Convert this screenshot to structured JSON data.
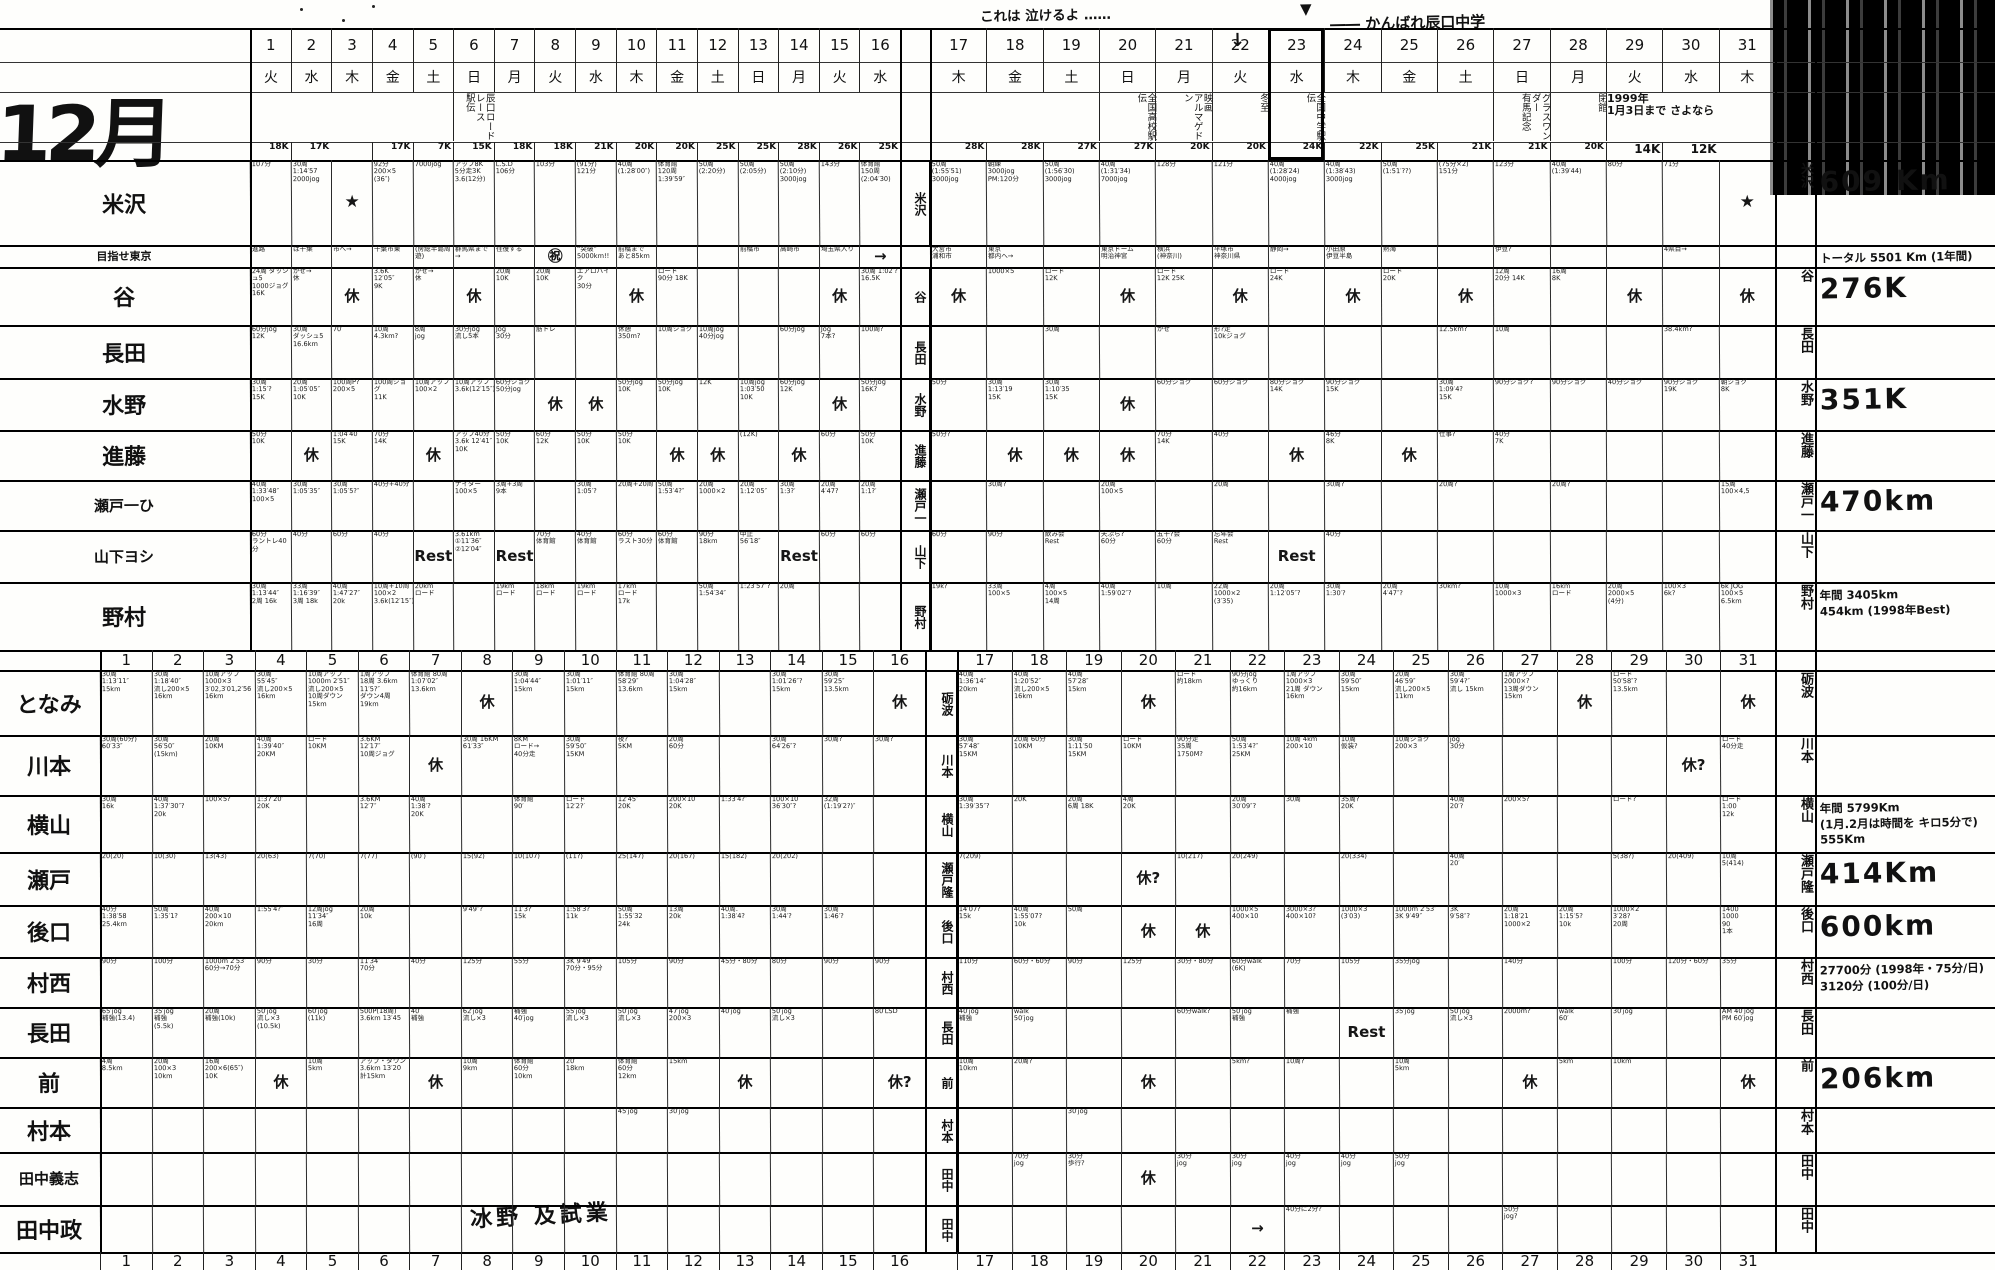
{
  "title": "12月",
  "annotations": {
    "cry_note": "これは 泣けるよ ‥‥‥",
    "cry_arrow": "↓",
    "cheer_note": "―― かんばれ辰口中学",
    "cheer_arrow": "▼",
    "footer_note": "冰野 及試業"
  },
  "days_left": [
    "1",
    "2",
    "3",
    "4",
    "5",
    "6",
    "7",
    "8",
    "9",
    "10",
    "11",
    "12",
    "13",
    "14",
    "15",
    "16"
  ],
  "days_right": [
    "17",
    "18",
    "19",
    "20",
    "21",
    "22",
    "23",
    "24",
    "25",
    "26",
    "27",
    "28",
    "29",
    "30",
    "31"
  ],
  "weekdays_left": [
    "火",
    "水",
    "木",
    "金",
    "土",
    "日",
    "月",
    "火",
    "水",
    "木",
    "金",
    "土",
    "日",
    "月",
    "火",
    "水"
  ],
  "weekdays_right": [
    "木",
    "金",
    "土",
    "日",
    "月",
    "火",
    "水",
    "木",
    "金",
    "土",
    "日",
    "月",
    "火",
    "水",
    "木"
  ],
  "events": {
    "6": "辰口ロードレース\n駅伝",
    "20": "全国高校駅伝",
    "21": "映画\nアルマゲドン",
    "22": "冬至",
    "23": "全国中学駅伝",
    "27": "グラスワンダー\n有馬記念",
    "28": "閉館",
    "29": "1999年\n1月3日まで さよなら"
  },
  "plan_k": [
    "18K",
    "17K",
    "",
    "17K",
    "7K",
    "15K",
    "18K",
    "18K",
    "21K",
    "20K",
    "20K",
    "25K",
    "25K",
    "28K",
    "26K",
    "25K",
    "28K",
    "28K",
    "27K",
    "27K",
    "20K",
    "20K",
    "24K",
    "22K",
    "25K",
    "21K",
    "21K",
    "20K",
    "14K",
    "12K",
    ""
  ],
  "upper_rows": [
    {
      "id": "yonezawa",
      "name": "米沢",
      "mid": "米沢",
      "total": "609 Km",
      "cells": [
        "107分",
        "30周\n1:14′57\n2000jog",
        "★",
        "92分\n200×5\n(36″)",
        "7000jog",
        "アップ8K\n5分走3K\n3.6(12分)",
        "L.S.D\n106分",
        "103分",
        "(91分)\n121分",
        "40周\n(1:28′00″)",
        "体育館\n120周\n1:39′59″",
        "50周\n(2:20分)",
        "50周\n(2:05分)",
        "50周\n(2:10分)\n3000jog",
        "143分",
        "体育館\n150周\n(2:04′30)",
        "50周\n(1:55′51)\n3000jog",
        "朝練\n3000jog\nPM:120分",
        "50周\n(1:56′30)\n3000jog",
        "40周\n(1:31′34)\n7000jog",
        "128分",
        "121分",
        "40周\n(1:28′24)\n4000jog",
        "40周\n(1:38′43)\n3000jog",
        "50周\n(1:51′??)",
        "(75分×2)\n151分",
        "123分",
        "40周\n(1:39′44)",
        "80分",
        "71分",
        "★"
      ]
    },
    {
      "id": "progress",
      "name": "目指せ東京",
      "mid": "",
      "total": "トータル 5501 Km (1年間)",
      "cells": [
        "進路",
        "は千葉",
        "市へ→",
        "千葉市東",
        "(房総半島周遊)",
        "群馬県まで→",
        "往復する",
        "㊗",
        "“突破”\n5000km!!",
        "前橋まで\nあと85km",
        "",
        "",
        "前橋市",
        "高崎市",
        "埼玉県入り",
        "→",
        "大宮市\n浦和市",
        "東京\n都内へ→",
        "",
        "東京ドーム\n明治神宮",
        "横浜\n(神奈川)",
        "平塚市\n神奈川県",
        "静岡→",
        "小田原\n伊豆半島",
        "熱海",
        "",
        "伊豆?",
        "",
        "",
        "4県目→",
        ""
      ]
    },
    {
      "id": "tani",
      "name": "谷",
      "mid": "谷",
      "total": "276K",
      "cells": [
        "24周 ダッシュ5\n1000ジョグ\n16K",
        "かぜ→\n休",
        "休",
        "3.6K\n12′05″\n9K",
        "かぜ→\n休",
        "休",
        "20周\n10K",
        "20周\n10K",
        "エアロバイク\n30分",
        "休",
        "ロード\n90分 18K",
        "",
        "",
        "",
        "休",
        "30周 1:02′?\n16.5K",
        "休",
        "1000×5",
        "ロード\n12K",
        "休",
        "ロード\n12K 25K",
        "休",
        "ロード\n24K",
        "休",
        "ロード\n20K",
        "休",
        "12周\n20分 14K",
        "16周\n8K",
        "休",
        "",
        "休"
      ]
    },
    {
      "id": "nagata-u",
      "name": "長田",
      "mid": "長田",
      "total": "",
      "cells": [
        "60分jog\n12K",
        "30周\nダッシュ5\n16.6km",
        "70′",
        "10周\n4.3km?",
        "8周\njog",
        "30分jog\n流し5本",
        "Jog\n30分",
        "筋トレ",
        "",
        "休憩\n350m?",
        "10周ジョグ",
        "10周jog\n40分jog",
        "",
        "60分jog",
        "Jog\n7本?",
        "100周?",
        "",
        "",
        "30周",
        "",
        "かぜ",
        "形?走\n10kジョグ",
        "",
        "",
        "",
        "12.5km?",
        "10周",
        "",
        "",
        "38.4km?",
        ""
      ]
    },
    {
      "id": "mizuno",
      "name": "水野",
      "mid": "水野",
      "total": "351K",
      "cells": [
        "30周\n1:15′?\n15K",
        "20周\n1:05′05″\n10K",
        "100周P?\n200×5",
        "100周ジョグ\n11K",
        "10周アップ\n100×2",
        "10周アップ\n3.6k(12′15″)",
        "60分ジョグ\n50分jog",
        "休",
        "休",
        "50分jog\n10K",
        "50分jog\n10K",
        "12K",
        "10周jog\n1:03′50\n10K",
        "60分jog\n12K",
        "休",
        "50分jog\n16K?",
        "50分",
        "30周\n1:13′19\n15K",
        "30周\n1:10′35\n15K",
        "休",
        "60分ジョグ",
        "60分ジョグ",
        "80分ジョグ\n14K",
        "90分ジョグ\n15K",
        "",
        "30周\n1:09′4?\n15K",
        "90分ジョグ?",
        "90分ジョグ",
        "40分ジョグ",
        "90分ジョグ\n19K",
        "朝ジョグ\n8K"
      ]
    },
    {
      "id": "shindo",
      "name": "進藤",
      "mid": "進藤",
      "total": "",
      "cells": [
        "50分\n10K",
        "休",
        "1:04′40\n15K",
        "70分\n14K",
        "休",
        "アップ40分\n3.6k 12′41″\n10K",
        "50分\n10K",
        "60分\n12K",
        "50分\n10K",
        "50分\n10K",
        "休",
        "休",
        "(12K)",
        "休",
        "60分",
        "50分\n10K",
        "50分?",
        "休",
        "休",
        "休",
        "70分\n14K",
        "40分",
        "休",
        "46分\n8K",
        "休",
        "仕事?",
        "40分\n7K",
        "",
        "",
        "",
        ""
      ]
    },
    {
      "id": "seto-h",
      "name": "瀬戸一ひ",
      "mid": "瀬戸一",
      "total": "470km",
      "cells": [
        "40周\n1:33′48″\n100×5",
        "30周\n1:05′35″",
        "30周\n1:05′5?″",
        "40分+40分",
        "",
        "ナイター\n100×5",
        "3周+3周\n9本",
        "",
        "30周\n1:05′?",
        "20周+20周",
        "50周\n1:53′4?″",
        "20周\n1000×2",
        "20周\n1:12′05″",
        "30周\n1:3?′",
        "20周\n4′47?",
        "20周\n1:1?′",
        "",
        "30周?",
        "",
        "20周\n100×5",
        "",
        "20周",
        "",
        "30周?",
        "",
        "20周?",
        "",
        "20周?",
        "",
        "",
        "15周\n100×4,5"
      ]
    },
    {
      "id": "yamashita",
      "name": "山下ヨシ",
      "mid": "山下",
      "total": "",
      "cells": [
        "60分\nラントレ40分",
        "40分",
        "60分",
        "40分",
        "Rest",
        "3.61km\n①11′36″\n②12′04″",
        "Rest",
        "70分\n体育館",
        "40分\n体育館",
        "60分\nラスト30分",
        "60分\n体育館",
        "90分\n18km",
        "中止\n56′18″",
        "Rest",
        "60分",
        "60分",
        "60分",
        "90分",
        "飲み会\nRest",
        "天ぷら?\n60分",
        "五十?会\n60分",
        "忘年会\nRest",
        "Rest",
        "40分",
        "",
        "",
        "",
        "",
        "",
        "",
        ""
      ]
    },
    {
      "id": "nomura",
      "name": "野村",
      "mid": "野村",
      "total": "年間 3405km\n454km (1998年Best)",
      "cells": [
        "30周\n1:13′44″\n2周 16k",
        "33周\n1:16′39″\n3周 18k",
        "40周\n1:47′27″\n20k",
        "10周+10周\n100×2\n3.6k(12′15″)",
        "20km\nロード",
        "",
        "19km\nロード",
        "18km\nロード",
        "19km\nロード",
        "17km\nロード\n17k",
        "",
        "50周\n1:54′34″",
        "1:23′57″?",
        "20周",
        "",
        "",
        "19k?",
        "33周\n100×5",
        "4周\n100×5\n14周",
        "40周\n1:59′02″?",
        "10周",
        "22周\n1000×2\n(3′35)",
        "20周\n1:12′05″?",
        "30周\n1:30′?",
        "20周\n4′47″?",
        "30km?",
        "10周\n1000×3",
        "16km\nロード",
        "20周\n2000×5\n(4分)",
        "100×3\n6k?",
        "6k JOG\n100×5\n6.5km"
      ]
    }
  ],
  "lower_rows": [
    {
      "id": "tonami",
      "name": "となみ",
      "mid": "砺波",
      "total": "",
      "cells": [
        "30周\n1:13′11″\n15km",
        "30周\n1:18′40″\n流し200×5\n16km",
        "10周アップ\n1000×3\n3′02,3′01,2′56\n16km",
        "30周\n55′45″\n流し200×5\n16km",
        "10周アップ\n1000m 2′51″\n流し200×5\n10周ダウン 15km",
        "1周アップ\n18周 3.6km 11′5?″\nダウン4周 19km",
        "体育館 80周\n1:07′02″\n13.6km",
        "休",
        "30周\n1:04′44″\n15km",
        "30周\n1:01′11″\n15km",
        "体育館 80周\n58′29″\n13.6km",
        "30周\n1:04′28″\n15km",
        "",
        "30周\n1:01′26″?\n15km",
        "30周\n59′25″\n13.5km",
        "休",
        "40周\n1:36′14″\n20km",
        "40周\n1:20′52″\n流し200×5 16km",
        "40周\n57′28″\n15km",
        "休",
        "ロード\n約18km",
        "90分jog\nゆっくり\n約16km",
        "1周アップ\n1000×3\n21周 ダウン 16km",
        "30周\n59′50″\n15km",
        "20周\n46′59″\n流し200×5 11km",
        "30周\n59′4?″\n流し 15km",
        "1周アップ\n2000×?\n13周ダウン 15km",
        "休",
        "ロード\n50′58″?\n13.5km",
        "",
        "休"
      ]
    },
    {
      "id": "kawamoto",
      "name": "川本",
      "mid": "川本",
      "total": "",
      "cells": [
        "30周(60分)\n60′33″",
        "30周\n56′50″\n(15km)",
        "20周\n10KM",
        "40周\n1:39′40″\n20KM",
        "ロード\n10KM",
        "3.6KM\n12′17″\n10周ジョグ",
        "休",
        "30周 16KM\n61′33″",
        "8KM\nロード→\n40分走",
        "30周\n59′50″\n15KM",
        "夜?\n5KM",
        "20周\n60分",
        "",
        "30周\n64′26″?",
        "30周?",
        "30周?",
        "30周\n57′48″\n15KM",
        "20周 60分\n10KM",
        "30周\n1:11′50\n15KM",
        "ロード\n10KM",
        "90分走\n35周\n1750M?",
        "50周\n1:53′4?″\n25KM",
        "10周 4km\n200×10",
        "10周\n仮装?",
        "10周ジョグ\n200×3",
        "jog\n30分",
        "",
        "",
        "",
        "休?",
        "ロード\n40分走"
      ]
    },
    {
      "id": "yokoyama",
      "name": "横山",
      "mid": "横山",
      "total": "年間 5799Km\n(1月.2月は時間を キロ5分で)\n555Km",
      "cells": [
        "30周\n16k",
        "40周\n1:37′30″?\n20k",
        "100×5?",
        "1:37′20″\n20K",
        "",
        "3.6KM\n12′7″",
        "40周\n1:38′?\n20K",
        "",
        "体育館\n90′",
        "ロード\n12′2?′",
        "12′45″\n20K",
        "200×10\n20K",
        "1:33′4?″",
        "100×10\n36′30″?",
        "32周\n(1:19′2?)″",
        "",
        "30周\n1:39′35″?",
        "20K",
        "20周\n6周 18K",
        "4周\n20K",
        "",
        "20周\n30′09″?",
        "30周",
        "35周?\n20K",
        "",
        "40周\n20′?",
        "200×5?",
        "",
        "ロード?",
        "",
        "ロード\n1:00\n12k"
      ]
    },
    {
      "id": "seto-t",
      "name": "瀬戸",
      "mid": "瀬戸隆",
      "total": "414Km",
      "cells": [
        "20(20)",
        "10(30)",
        "13(43)",
        "20(63)",
        "7(70)",
        "7(77)",
        "(90′)",
        "15(92)",
        "10(107)",
        "(11?)",
        "25(147)",
        "20(167)",
        "15(182)",
        "20(202)",
        "",
        "",
        "7(209)",
        "",
        "",
        "休?",
        "10(217)",
        "20(249)",
        "",
        "20(334)",
        "",
        "40周\n20′",
        "",
        "",
        "5(38?)",
        "20(409)",
        "10周\n5(414)"
      ]
    },
    {
      "id": "ushiroguchi",
      "name": "後口",
      "mid": "後口",
      "total": "600km",
      "cells": [
        "40分\n1:38′58\n25.4km",
        "50周\n1:35′1?",
        "40周\n200×10\n20km",
        "1:55′4?″",
        "12周jog\n11′34″\n16周",
        "20周\n10k",
        "",
        "9′49″?",
        "11′3?′\n15k",
        "1:58′3?\n11k",
        "50周\n1:55′32\n24k",
        "13周\n20k",
        "40周.\n1:38′4?",
        "30周\n1:44′?",
        "30周\n1:46′?",
        "",
        "14′07?\n15k",
        "40周\n1:55′07?\n10k",
        "50周",
        "休",
        "休",
        "1000×5\n400×10",
        "3000×3?\n400×10?",
        "1000×3\n(3′03)",
        "1000m 2′53″\n3K 9′49″",
        "3K\n9′58″?",
        "20周\n1:18′21\n1000×2",
        "20周\n1:15′5?\n10k",
        "1000×2\n3′28?\n20周",
        "",
        "1400\n1000\n90\n1本"
      ]
    },
    {
      "id": "muranishi",
      "name": "村西",
      "mid": "村西",
      "total": "27700分 (1998年・75分/日)\n3120分 (100分/日)",
      "cells": [
        "90分",
        "100分",
        "1000m 2′53″\n60分→70分",
        "90分",
        "30分",
        "11′34″\n70分",
        "40分",
        "125分",
        "55分",
        "3K 9′49″\n70分・95分",
        "105分",
        "90分",
        "45分・80分",
        "80分",
        "90分",
        "90分",
        "110分",
        "60分・60分",
        "90分",
        "125分",
        "30分・80分",
        "60分walk\n(6K)",
        "70分",
        "105分",
        "35分jog",
        "",
        "140分",
        "",
        "100分",
        "120分・60分",
        "35分"
      ]
    },
    {
      "id": "nagata-l",
      "name": "長田",
      "mid": "長田",
      "total": "",
      "cells": [
        "65′jog\n補強(13.4)",
        "35′jog\n補強\n(5.5k)",
        "20周\n補強(10k)",
        "50′jog\n流し×3\n(10.5k)",
        "60′jog\n(11k)",
        "500P(18周)\n3.6km 13′45",
        "40′\n補強",
        "62′jog\n流し×3",
        "補強\n40′jog",
        "55′jog\n流し×3",
        "50′jog\n流し×3",
        "47′jog\n200×3",
        "40′jog",
        "50′jog\n流し×3",
        "",
        "80′LSD",
        "40′jog\n補強",
        "walk\n50′jog",
        "",
        "",
        "60分walk?",
        "50′jog\n補強",
        "補強",
        "Rest",
        "35′jog",
        "50′jog\n流し×3",
        "2000m?",
        "walk\n60′",
        "30′jog",
        "",
        "AM 40′jog\nPM 60′jog"
      ]
    },
    {
      "id": "mae",
      "name": "前",
      "mid": "前",
      "total": "206km",
      "cells": [
        "4周\n8.5km",
        "20周\n100×3\n10km",
        "16周\n200×6(65″)\n10K",
        "休",
        "10周\n5km",
        "アップ・ダウン\n3.6km 13′20\n計15km",
        "休",
        "10周\n9km",
        "体育館\n60分\n10km",
        "20′\n18km",
        "体育館\n60分\n12km",
        "15km",
        "休",
        "",
        "",
        "休?",
        "10周\n10km",
        "20周?",
        "",
        "休",
        "",
        "5km?",
        "10周?",
        "",
        "10周\n5km",
        "",
        "休",
        "5km",
        "10km",
        "",
        "休"
      ]
    },
    {
      "id": "muramoto",
      "name": "村本",
      "mid": "村本",
      "total": "",
      "cells": [
        "",
        "",
        "",
        "",
        "",
        "",
        "",
        "",
        "",
        "",
        "45′jog",
        "30′jog",
        "",
        "",
        "",
        "",
        "",
        "",
        "30′jog",
        "",
        "",
        "",
        "",
        "",
        "",
        "",
        "",
        "",
        "",
        "",
        ""
      ]
    },
    {
      "id": "tanaka-y",
      "name": "田中義志",
      "mid": "田中",
      "total": "",
      "cells": [
        "",
        "",
        "",
        "",
        "",
        "",
        "",
        "",
        "",
        "",
        "",
        "",
        "",
        "",
        "",
        "",
        "",
        "70分\njog",
        "30分\n歩行?",
        "休",
        "30分\njog",
        "30分\njog",
        "40分\njog",
        "40分\njog",
        "50分\njog",
        "",
        "",
        "",
        "",
        "",
        ""
      ]
    },
    {
      "id": "tanaka-m",
      "name": "田中政",
      "mid": "田中",
      "total": "",
      "cells": [
        "",
        "",
        "",
        "",
        "",
        "",
        "",
        "",
        "",
        "",
        "",
        "",
        "",
        "",
        "",
        "",
        "",
        "",
        "",
        "",
        "",
        "→",
        "40分に2分?",
        "",
        "",
        "",
        "50分\njog?",
        "",
        "",
        "",
        ""
      ]
    }
  ]
}
